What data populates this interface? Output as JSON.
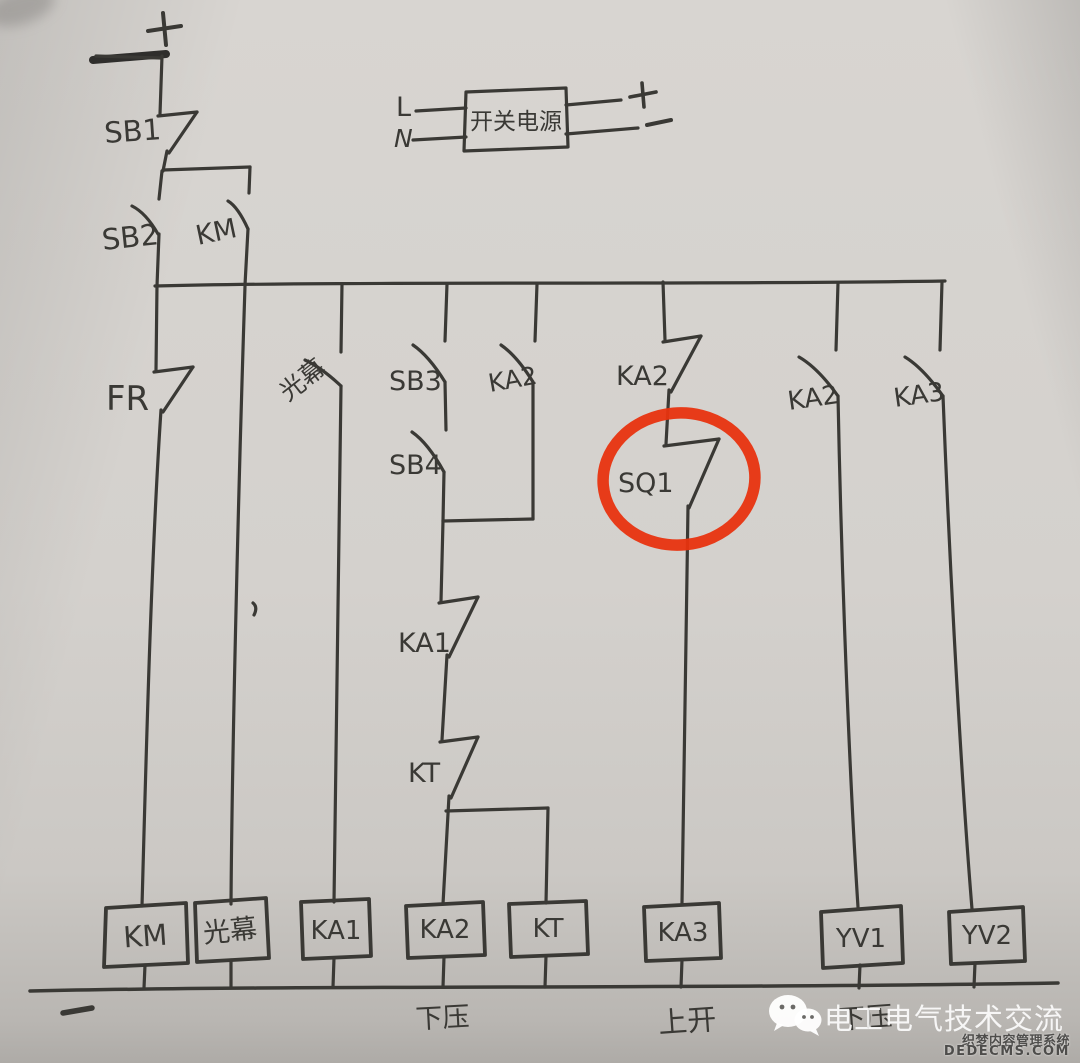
{
  "top_feed": {
    "plus": "+",
    "sb1": "SB1",
    "sb2": "SB2",
    "km": "KM"
  },
  "power_supply": {
    "line": "L",
    "neutral": "N",
    "box_label": "开关电源",
    "plus": "+",
    "minus": "−"
  },
  "rungs": {
    "fr": "FR",
    "light_curtain_contact": "光幕",
    "sb3": "SB3",
    "sb4": "SB4",
    "ka2_seal_in": "KA2",
    "ka1_nc": "KA1",
    "kt_nc": "KT",
    "ka2_nc": "KA2",
    "sq1": "SQ1",
    "ka2_no": "KA2",
    "ka3_no": "KA3"
  },
  "coils": [
    "KM",
    "光幕",
    "KA1",
    "KA2",
    "KT",
    "KA3",
    "YV1",
    "YV2"
  ],
  "bottom": {
    "minus": "−",
    "label_down": "下压",
    "label_up": "上开",
    "label_down2": "下压"
  },
  "watermarks": {
    "wechat_text": "电工电气技术交流",
    "cms_name": "织梦内容管理系统",
    "cms_domain": "DEDECMS.COM"
  },
  "highlight": {
    "color": "#e8330f",
    "around": "SQ1"
  }
}
